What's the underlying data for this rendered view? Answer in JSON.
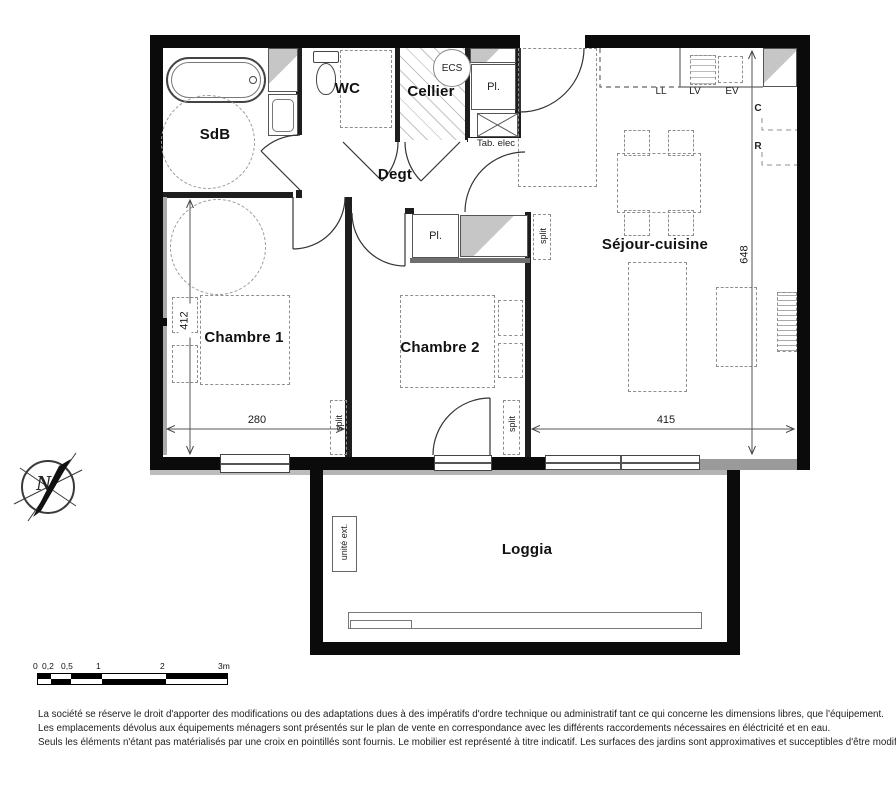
{
  "plan": {
    "rooms": {
      "sdb": "SdB",
      "wc": "WC",
      "cellier": "Cellier",
      "degt": "Degt",
      "chambre1": "Chambre 1",
      "chambre2": "Chambre 2",
      "sejour": "Séjour-cuisine",
      "loggia": "Loggia"
    },
    "labels": {
      "ecs": "ECS",
      "pl": "Pl.",
      "tab_elec": "Tab. elec",
      "ll": "LL",
      "lv": "LV",
      "ev": "EV",
      "c": "C",
      "r": "R",
      "split": "split",
      "unite_ext": "unité ext.",
      "north": "N"
    },
    "dims": {
      "chambre1_height": "412",
      "chambre1_width": "280",
      "sejour_height": "648",
      "sejour_width": "415"
    }
  },
  "scalebar": {
    "labels": [
      "0",
      "0,2",
      "0,5",
      "1",
      "2",
      "3m"
    ]
  },
  "disclaimer": {
    "lines": [
      "La société se réserve le droit  d'apporter des modifications ou des adaptations dues à des impératifs d'ordre technique ou administratif tant ce qui concerne les dimensions libres, que l'équipement.",
      "Les emplacements dévolus aux équipements ménagers sont présentés sur le plan de vente en correspondance avec les différents raccordements nécessaires en éléctricité et en eau.",
      "Seuls les éléments n'étant pas matérialisés par une croix en pointillés sont fournis. Le mobilier est représenté à titre indicatif. Les surfaces des jardins sont approximatives et succeptibles d'être modifiées."
    ]
  }
}
